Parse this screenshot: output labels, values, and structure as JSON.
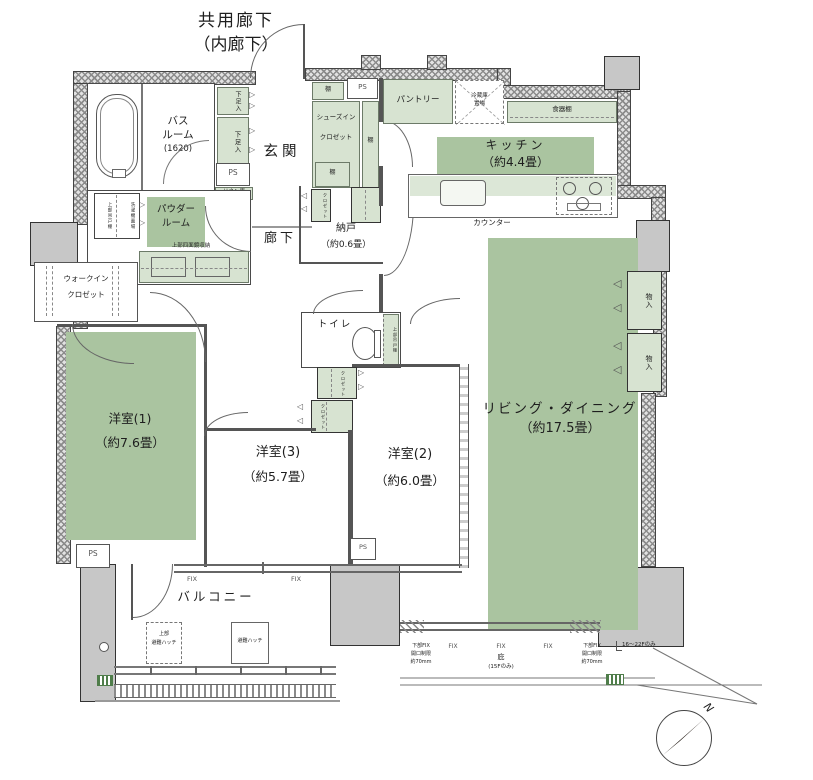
{
  "colors": {
    "room_green": "#aac4a0",
    "fixture_green": "#d7e3d1",
    "column_gray": "#c7c7c7"
  },
  "top": {
    "common_corridor_1": "共用廊下",
    "common_corridor_2": "（内廊下）"
  },
  "rooms": {
    "bathroom_1": "バス",
    "bathroom_2": "ルーム",
    "bathroom_size": "(1620)",
    "entrance": "玄関",
    "hallway": "廊下",
    "powder_1": "パウダー",
    "powder_2": "ルーム",
    "pantry": "パントリー",
    "kitchen_1": "キッチン",
    "kitchen_2": "（約4.4畳）",
    "living_1": "リビング・ダイニング",
    "living_2": "（約17.5畳）",
    "bedroom1_1": "洋室(1)",
    "bedroom1_2": "（約7.6畳）",
    "bedroom2_1": "洋室(2)",
    "bedroom2_2": "（約6.0畳）",
    "bedroom3_1": "洋室(3)",
    "bedroom3_2": "（約5.7畳）",
    "storage_1": "納戸",
    "storage_2": "（約0.6畳）",
    "wic_1": "ウォークイン",
    "wic_2": "クロゼット",
    "toilet": "トイレ",
    "balcony": "バルコニー"
  },
  "fixtures": {
    "shoe_box": "下足入",
    "ps": "PS",
    "linen": "リネン庫",
    "shoes_closet_1": "シューズイン",
    "shoes_closet_2": "クロゼット",
    "shelf": "棚",
    "fridge_1": "冷蔵庫",
    "fridge_2": "置場",
    "dish_shelf": "食器棚",
    "counter": "カウンター",
    "upper_cabinet": "上部吊戸棚",
    "washer": "洗濯機置場",
    "mirror_storage": "上部四面鏡収納",
    "closet": "クロゼット",
    "storage_in": "物入",
    "hatch_upper_1": "上部",
    "hatch_upper_2": "避難ハッチ",
    "hatch": "避難ハッチ"
  },
  "annotations": {
    "fix": "FIX",
    "fix_limit_1": "下部FIX",
    "fix_limit_2": "開口制限",
    "fix_limit_3": "約70mm",
    "eaves_1": "庇",
    "eaves_2": "(15Fのみ)",
    "floors_note": "16～22Fのみ",
    "north": "N"
  },
  "icons": {
    "fold_door_right": "▷",
    "fold_door_left": "◁"
  }
}
